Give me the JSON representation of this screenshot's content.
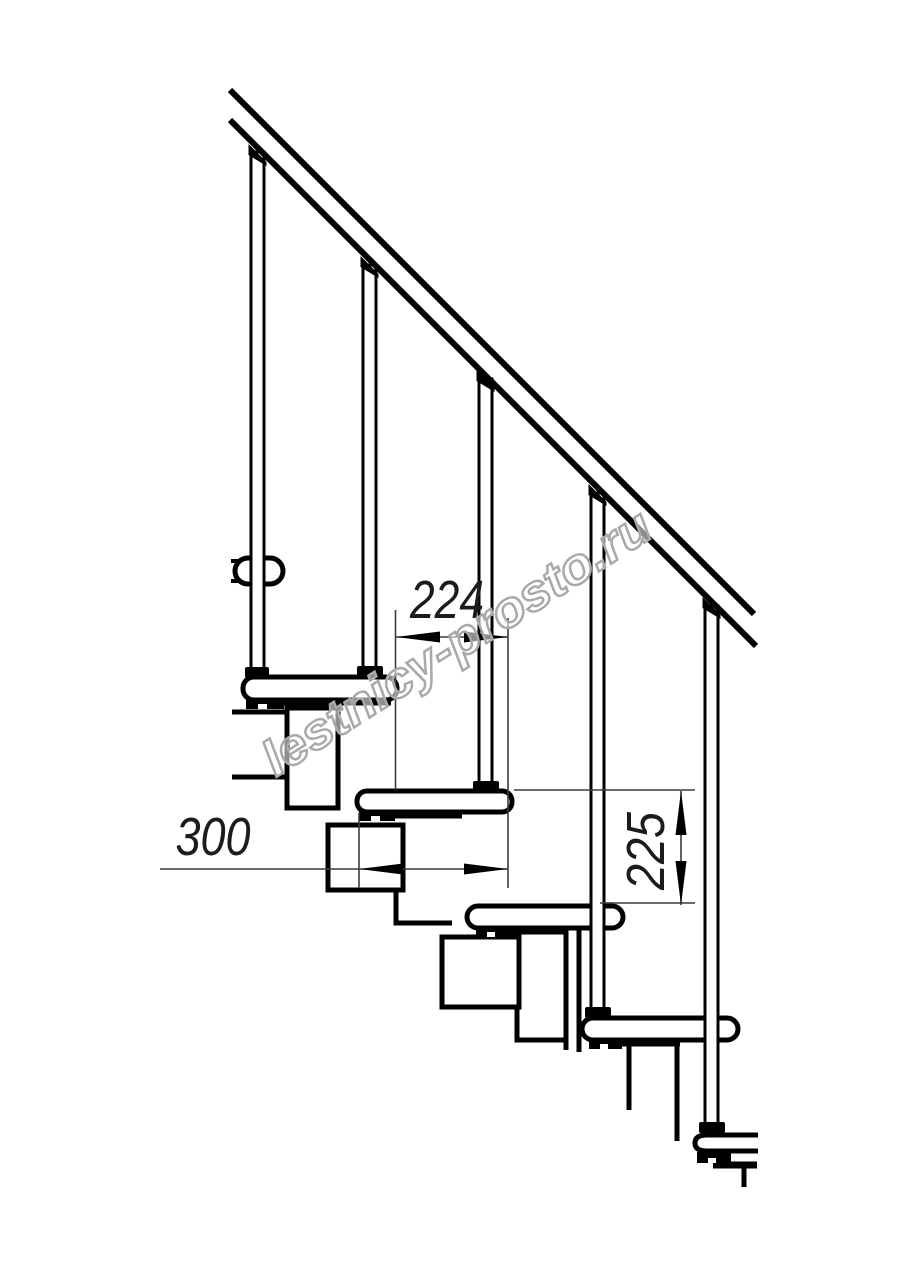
{
  "page": {
    "background": "#ffffff",
    "line_color": "#000000",
    "dim_line_color": "#3c3c3c"
  },
  "watermark": {
    "text": "lestnicy-prosto.ru",
    "color": "#a9a9a9"
  },
  "dimensions": {
    "tread_spacing": {
      "value": "224"
    },
    "tread_length": {
      "value": "300"
    },
    "rise_height": {
      "value": "225"
    }
  }
}
